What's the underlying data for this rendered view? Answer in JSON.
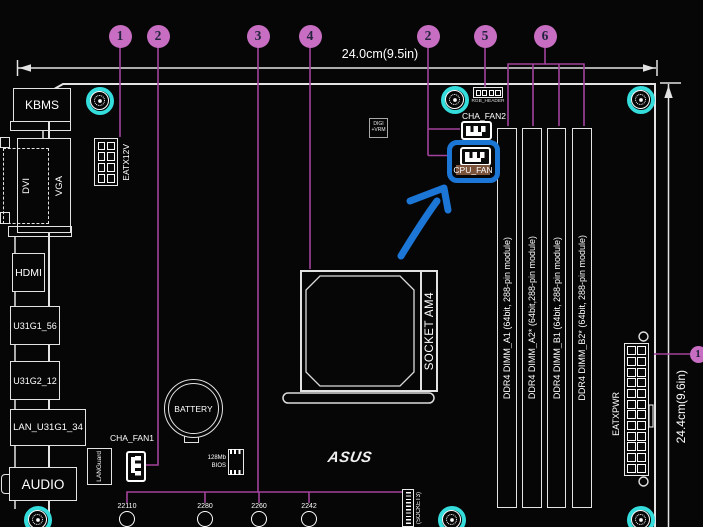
{
  "diagram": {
    "board_width_label": "24.0cm(9.5in)",
    "board_height_label": "24.4cm(9.6in)",
    "asus_logo": "ASUS"
  },
  "callouts": {
    "top": [
      "1",
      "2",
      "3",
      "4",
      "2",
      "5",
      "6"
    ],
    "right": "1"
  },
  "rear_ports": [
    "KBMS",
    "DVI",
    "VGA",
    "HDMI",
    "U31G1_56",
    "U31G2_12",
    "LAN_U31G1_34",
    "AUDIO"
  ],
  "components": {
    "eatx12v": "EATX12V",
    "eatxpwr": "EATXPWR",
    "cha_fan1": "CHA_FAN1",
    "cha_fan2": "CHA_FAN2",
    "cpu_fan": "CPU_FAN",
    "rgb_header": "RGB_HEADER",
    "digi_vrm_line1": "DIGI",
    "digi_vrm_line2": "+VRM",
    "lan_guard": "LANGuard",
    "battery": "BATTERY",
    "bios_line1": "128Mb",
    "bios_line2": "BIOS",
    "cpu_socket": "SOCKET AM4",
    "m2_socket": "(SOCKET3)"
  },
  "m2_standoffs": [
    "22110",
    "2280",
    "2260",
    "2242"
  ],
  "dimm_slots": [
    "DDR4 DIMM_A1 (64bit, 288-pin module)",
    "DDR4 DIMM_A2* (64bit,288-pin module)",
    "DDR4 DIMM_B1 (64bit, 288-pin module)",
    "DDR4 DIMM_B2* (64bit, 288-pin module)"
  ],
  "annotation": {
    "target": "CPU_FAN"
  },
  "colors": {
    "mount_hole_cyan": "#35dcdc",
    "callout_fill": "#c76ec2",
    "callout_line": "#a2429c",
    "annotation_blue": "#1b76d6",
    "target_highlight": "#7b523a",
    "line_art": "#e3e3e3"
  }
}
